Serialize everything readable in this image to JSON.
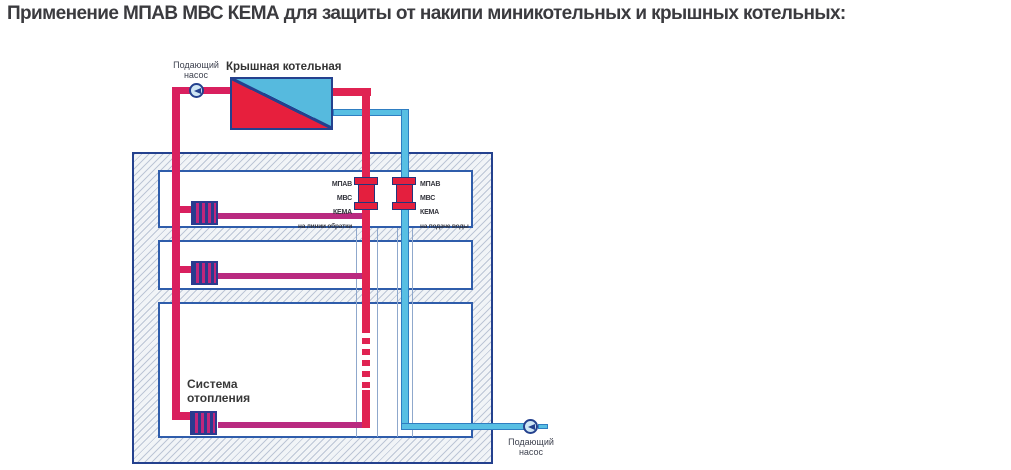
{
  "title": "Применение МПАВ МВС КЕМА для защиты от накипи миникотельных и крышных котельных:",
  "diagram": {
    "boiler": {
      "label": "Крышная котельная"
    },
    "pump_top": {
      "label": "Подающий\nнасос"
    },
    "pump_bottom": {
      "label": "Подающий\nнасос"
    },
    "heating_system": {
      "label": "Система\nотопления"
    },
    "device_return": {
      "lines": [
        "МПАВ",
        "МВС",
        "КЕМА",
        "на линии обратки"
      ]
    },
    "device_supply": {
      "lines": [
        "МПАВ",
        "МВС",
        "КЕМА",
        "на подаче воды"
      ]
    },
    "icons": {
      "pump": "circle-with-left-triangle",
      "radiator": "striped-rectangle"
    },
    "colors": {
      "hot_pipe": "#d9205f",
      "return_pipe_magenta": "#b92a80",
      "riser_red": "#e02352",
      "cold_pipe_cyan": "#58bfe3",
      "cold_pipe_edge": "#2f7ec2",
      "navy_outline": "#24418e",
      "room_border": "#2f5dab",
      "boiler_red": "#e71f3d",
      "boiler_cyan": "#56bade",
      "device_red": "#e41f3e",
      "text": "#3b3b3f"
    }
  }
}
